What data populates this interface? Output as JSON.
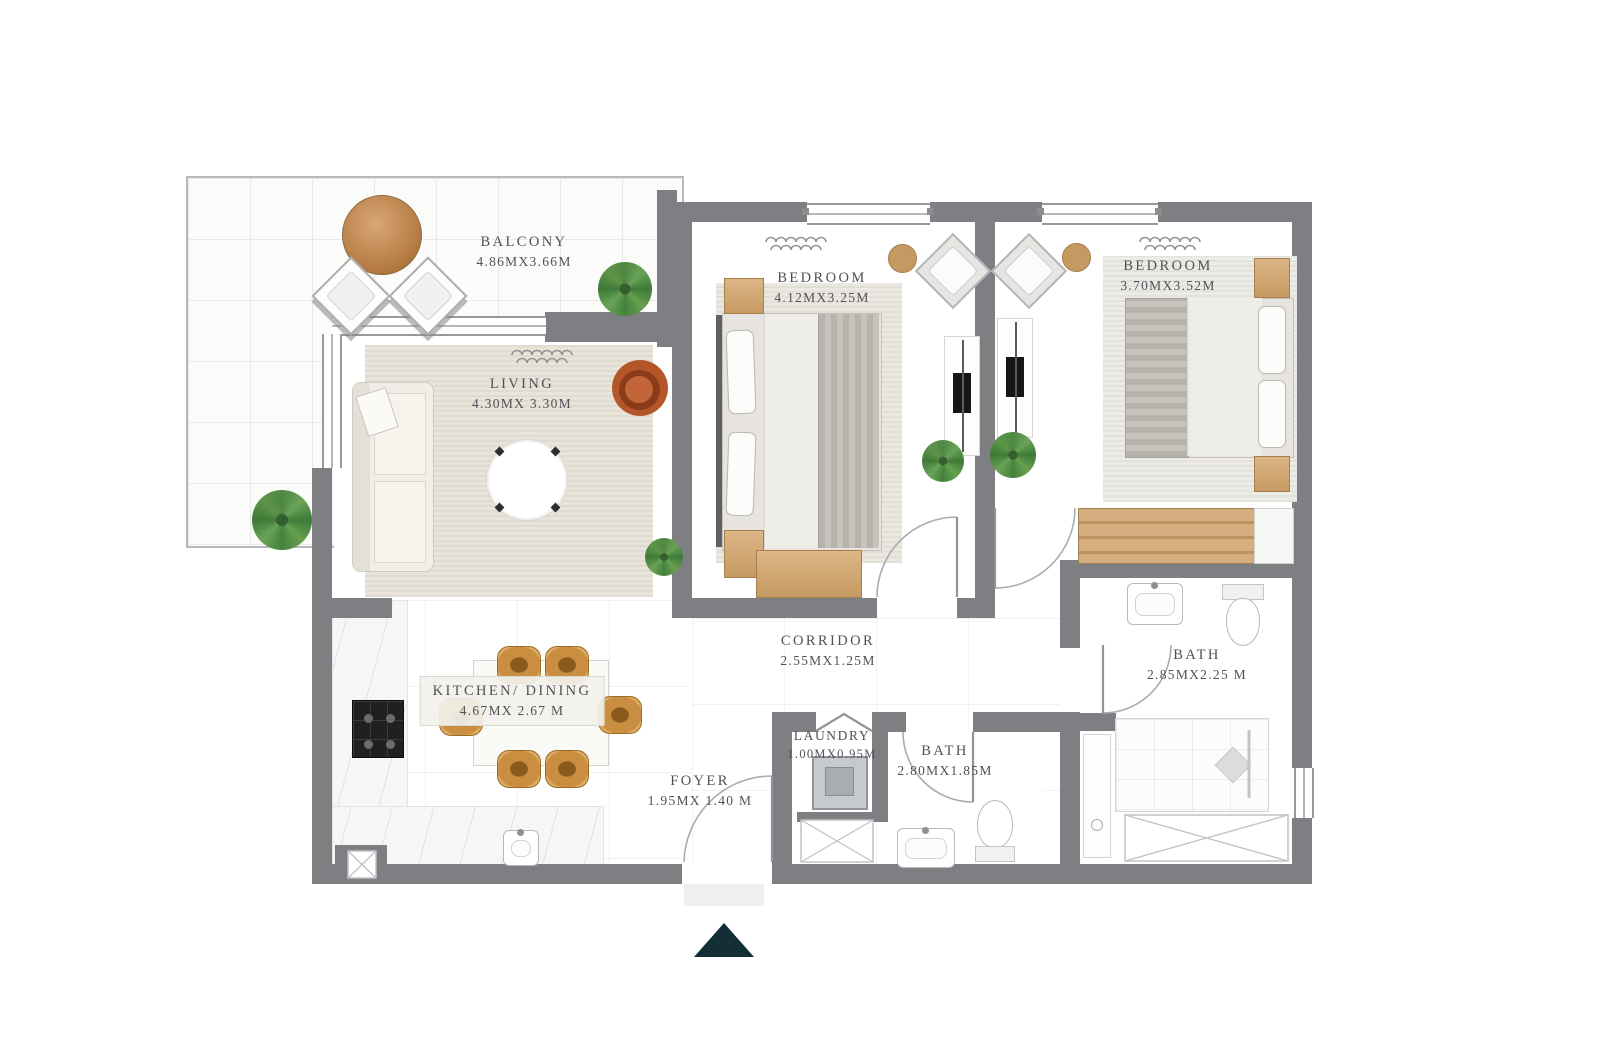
{
  "plan": {
    "rooms": [
      {
        "name": "BALCONY",
        "dims": "4.86MX3.66M"
      },
      {
        "name": "LIVING",
        "dims": "4.30MX 3.30M"
      },
      {
        "name": "BEDROOM",
        "dims": "4.12MX3.25M"
      },
      {
        "name": "BEDROOM",
        "dims": "3.70MX3.52M"
      },
      {
        "name": "CORRIDOR",
        "dims": "2.55MX1.25M"
      },
      {
        "name": "KITCHEN/ DINING",
        "dims": "4.67MX 2.67 M"
      },
      {
        "name": "LAUNDRY",
        "dims": "1.00MX0.95M"
      },
      {
        "name": "BATH",
        "dims": "2.80MX1.85M"
      },
      {
        "name": "BATH",
        "dims": "2.85MX2.25 M"
      },
      {
        "name": "FOYER",
        "dims": "1.95MX 1.40 M"
      }
    ],
    "entrance_marker": {
      "shape": "triangle-up",
      "color": "#132e36"
    },
    "colors": {
      "wall_gray": "#7d7f82",
      "label_gray": "#4f5156",
      "wood_tan": "#c9a06a",
      "dining_chair_orange": "#c98e3f",
      "plant_green": "#4e8743",
      "floor_white": "#ffffff"
    }
  }
}
